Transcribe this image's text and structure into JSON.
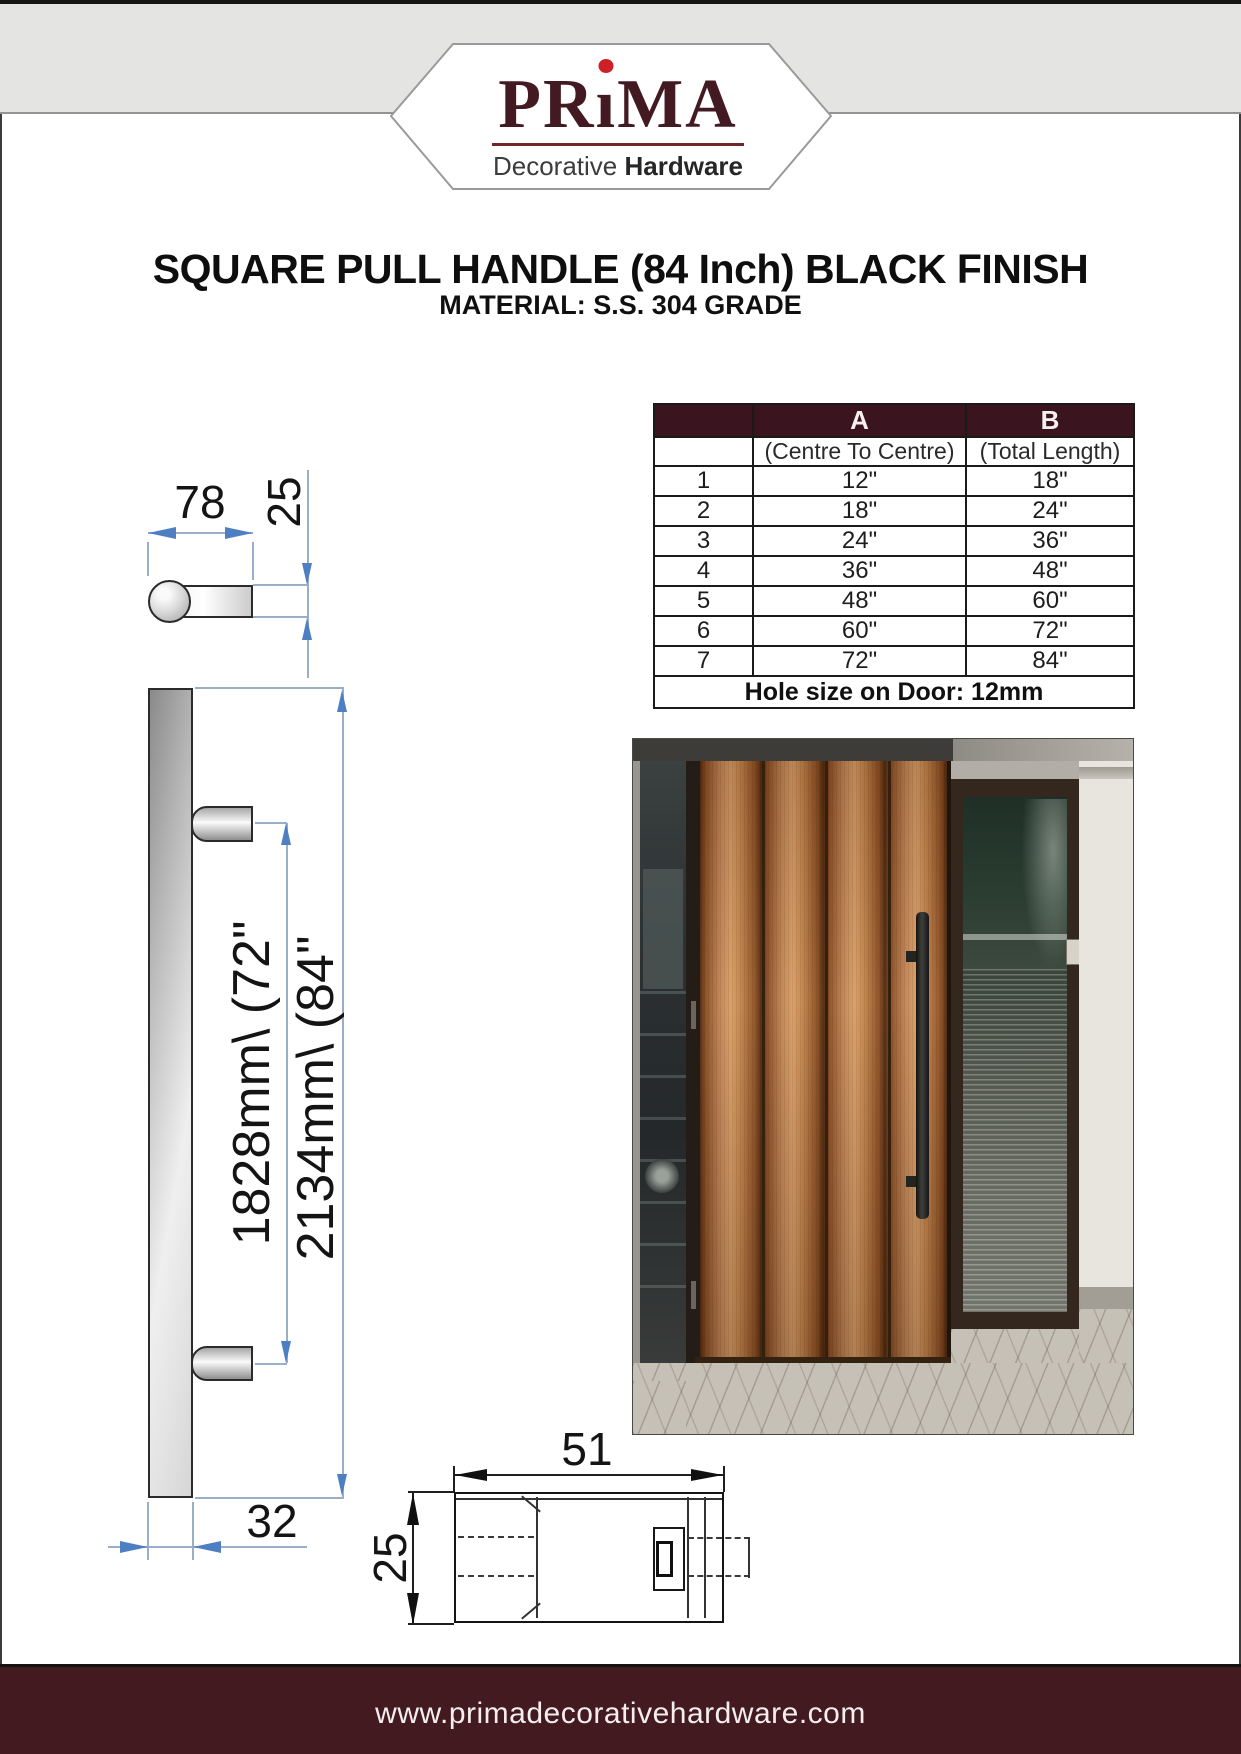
{
  "header": {
    "logo": {
      "part1": "PR",
      "i_dotless": "ı",
      "part2": "MA",
      "tagline_light": "Decorative",
      "tagline_bold": "Hardware"
    }
  },
  "title": {
    "line1": "SQUARE PULL HANDLE (84 Inch) BLACK FINISH",
    "line2": "MATERIAL: S.S. 304 GRADE"
  },
  "size_table": {
    "col_a": "A",
    "col_b": "B",
    "col_a_sub": "(Centre To Centre)",
    "col_b_sub": "(Total Length)",
    "rows": [
      {
        "no": "1",
        "a": "12\"",
        "b": "18\""
      },
      {
        "no": "2",
        "a": "18\"",
        "b": "24\""
      },
      {
        "no": "3",
        "a": "24\"",
        "b": "36\""
      },
      {
        "no": "4",
        "a": "36\"",
        "b": "48\""
      },
      {
        "no": "5",
        "a": "48\"",
        "b": "60\""
      },
      {
        "no": "6",
        "a": "60\"",
        "b": "72\""
      },
      {
        "no": "7",
        "a": "72\"",
        "b": "84\""
      }
    ],
    "note": "Hole size on Door: 12mm"
  },
  "drawings": {
    "top_view": {
      "width": "78",
      "thickness": "25"
    },
    "side_view": {
      "centre_to_centre": "1828mm\\ (72\"",
      "total_length": "2134mm\\ (84\"",
      "projection": "32"
    },
    "section_view": {
      "length": "51",
      "height": "25"
    }
  },
  "footer": {
    "website": "www.primadecorativehardware.com"
  },
  "colors": {
    "brand_maroon": "#431a21",
    "red_dot": "#ce2127",
    "table_header_bg": "#3a1520",
    "footer_bg": "#421a20",
    "dimension_blue": "#4d7fc2"
  }
}
